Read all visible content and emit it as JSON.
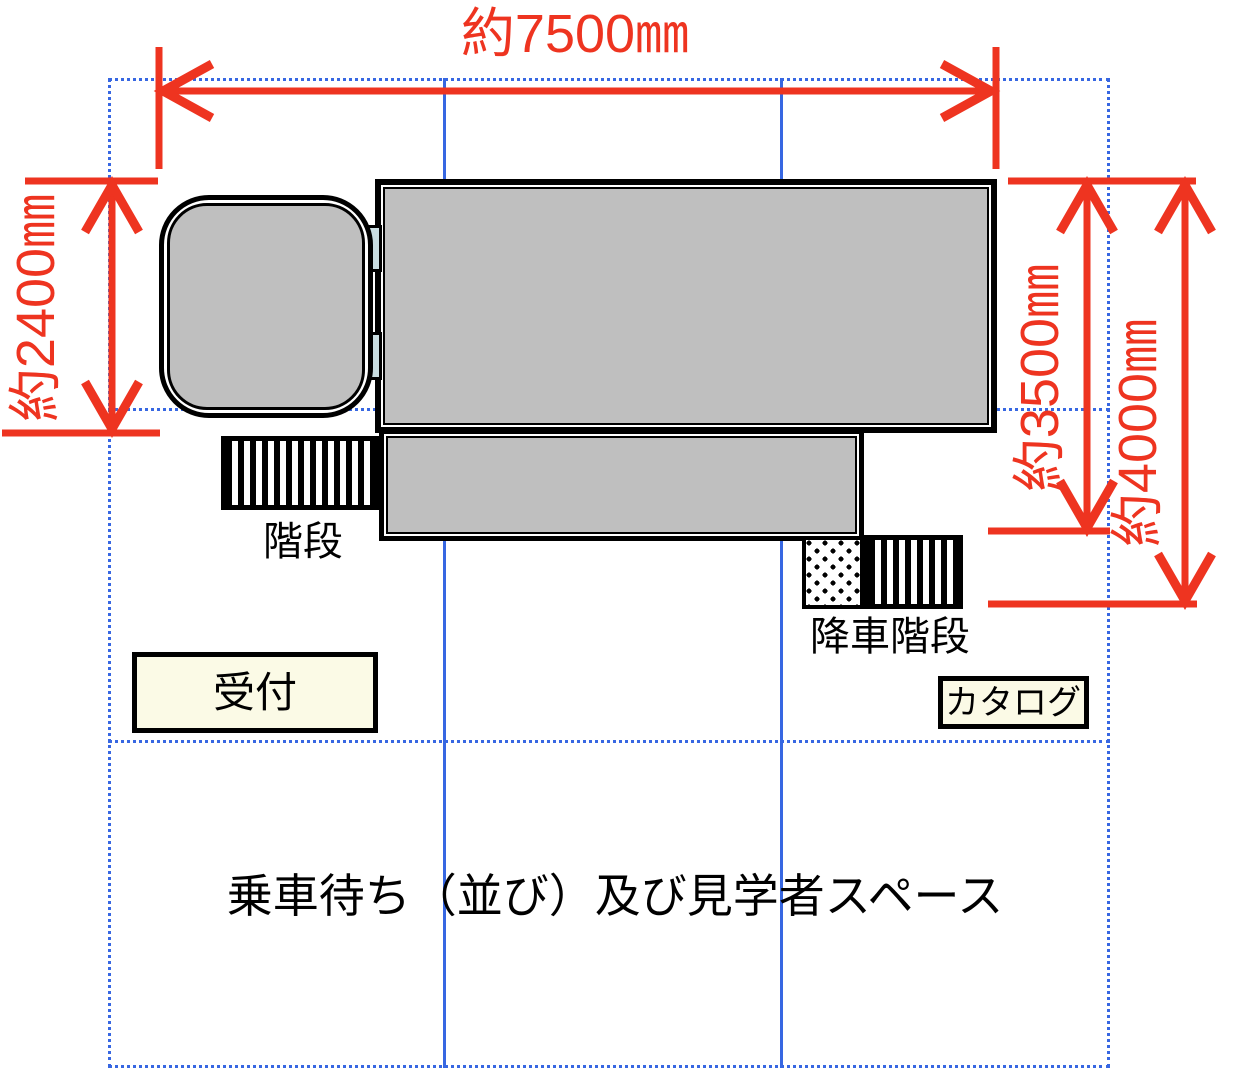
{
  "diagram": {
    "title_context": "vehicle exhibit floor plan",
    "dimensions": {
      "width_top": "約7500㎜",
      "height_left": "約2400㎜",
      "height_right_inner": "約3500㎜",
      "height_right_outer": "約4000㎜"
    },
    "labels": {
      "stairs": "階段",
      "exit_stairs": "降車階段",
      "reception": "受付",
      "catalog": "カタログ",
      "waiting_area": "乗車待ち（並び）及び見学者スペース"
    },
    "colors": {
      "dimension_red": "#ee3420",
      "grid_blue": "#3767e2",
      "vehicle_gray": "#bfbfbf",
      "panel_cream": "#fbfae6",
      "connector_cyan": "#c9dde1"
    }
  }
}
